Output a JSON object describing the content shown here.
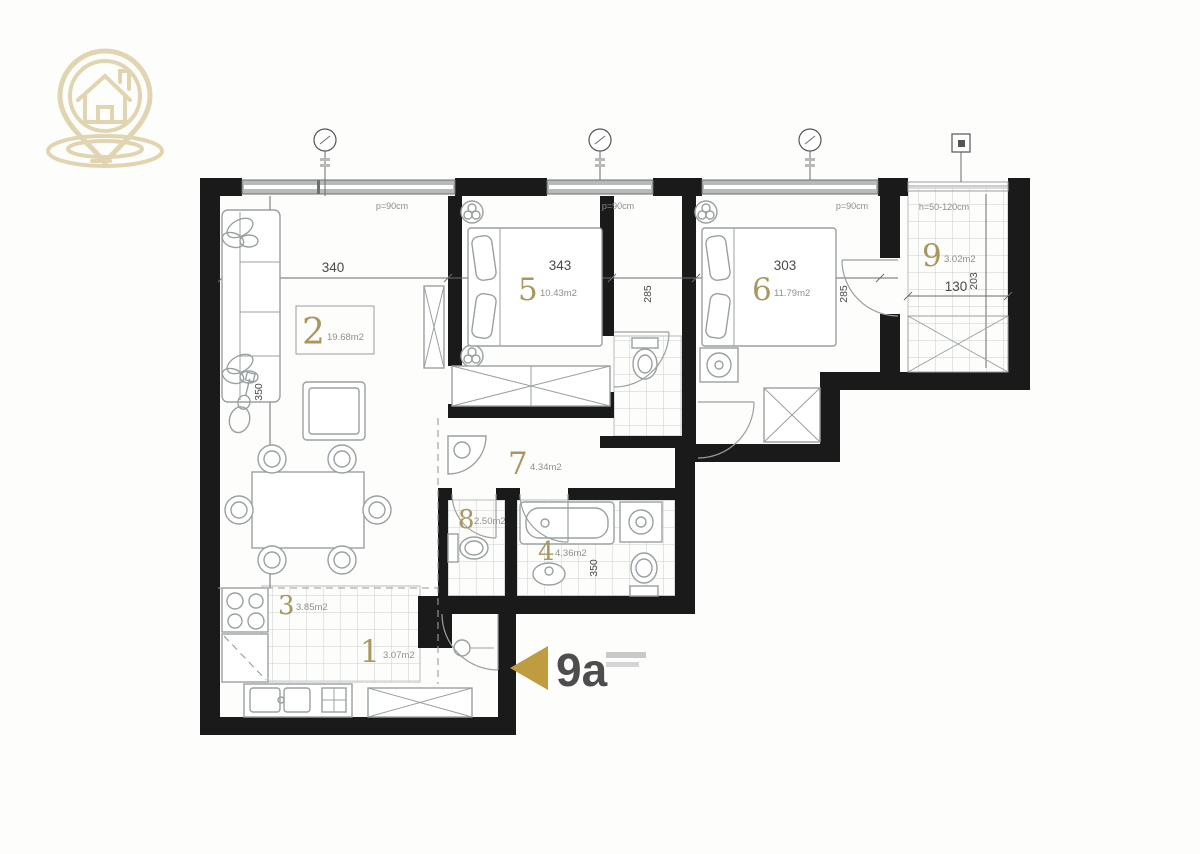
{
  "title": "Apartment floor plan",
  "unit": {
    "label": "9a"
  },
  "rooms": [
    {
      "number": "1",
      "area": "3.07m2"
    },
    {
      "number": "2",
      "area": "19.68m2"
    },
    {
      "number": "3",
      "area": "3.85m2"
    },
    {
      "number": "4",
      "area": "4.36m2"
    },
    {
      "number": "5",
      "area": "10.43m2"
    },
    {
      "number": "6",
      "area": "11.79m2"
    },
    {
      "number": "7",
      "area": "4.34m2"
    },
    {
      "number": "8",
      "area": "2.50m2"
    },
    {
      "number": "9",
      "area": "3.02m2"
    }
  ],
  "dimensions": {
    "d340": "340",
    "d343": "343",
    "d303": "303",
    "d130": "130",
    "d285a": "285",
    "d285b": "285",
    "d203": "203",
    "d350a": "350",
    "d350b": "350"
  },
  "annotations": {
    "w1": "p=90cm",
    "w2": "p=90cm",
    "w3": "p=90cm",
    "terrace": "h=50-120cm"
  },
  "icons": {
    "logo": "house-location-pin-icon",
    "entrance_arrow": "entrance-triangle-icon"
  },
  "colors": {
    "wall": "#1a1a1a",
    "gold": "#a8985f",
    "logo": "#e1d5b1",
    "triangle": "#bf9c40",
    "furniture": "#9aa0a0",
    "dim": "#4a4a4a",
    "tile": "#cbcfcf"
  }
}
